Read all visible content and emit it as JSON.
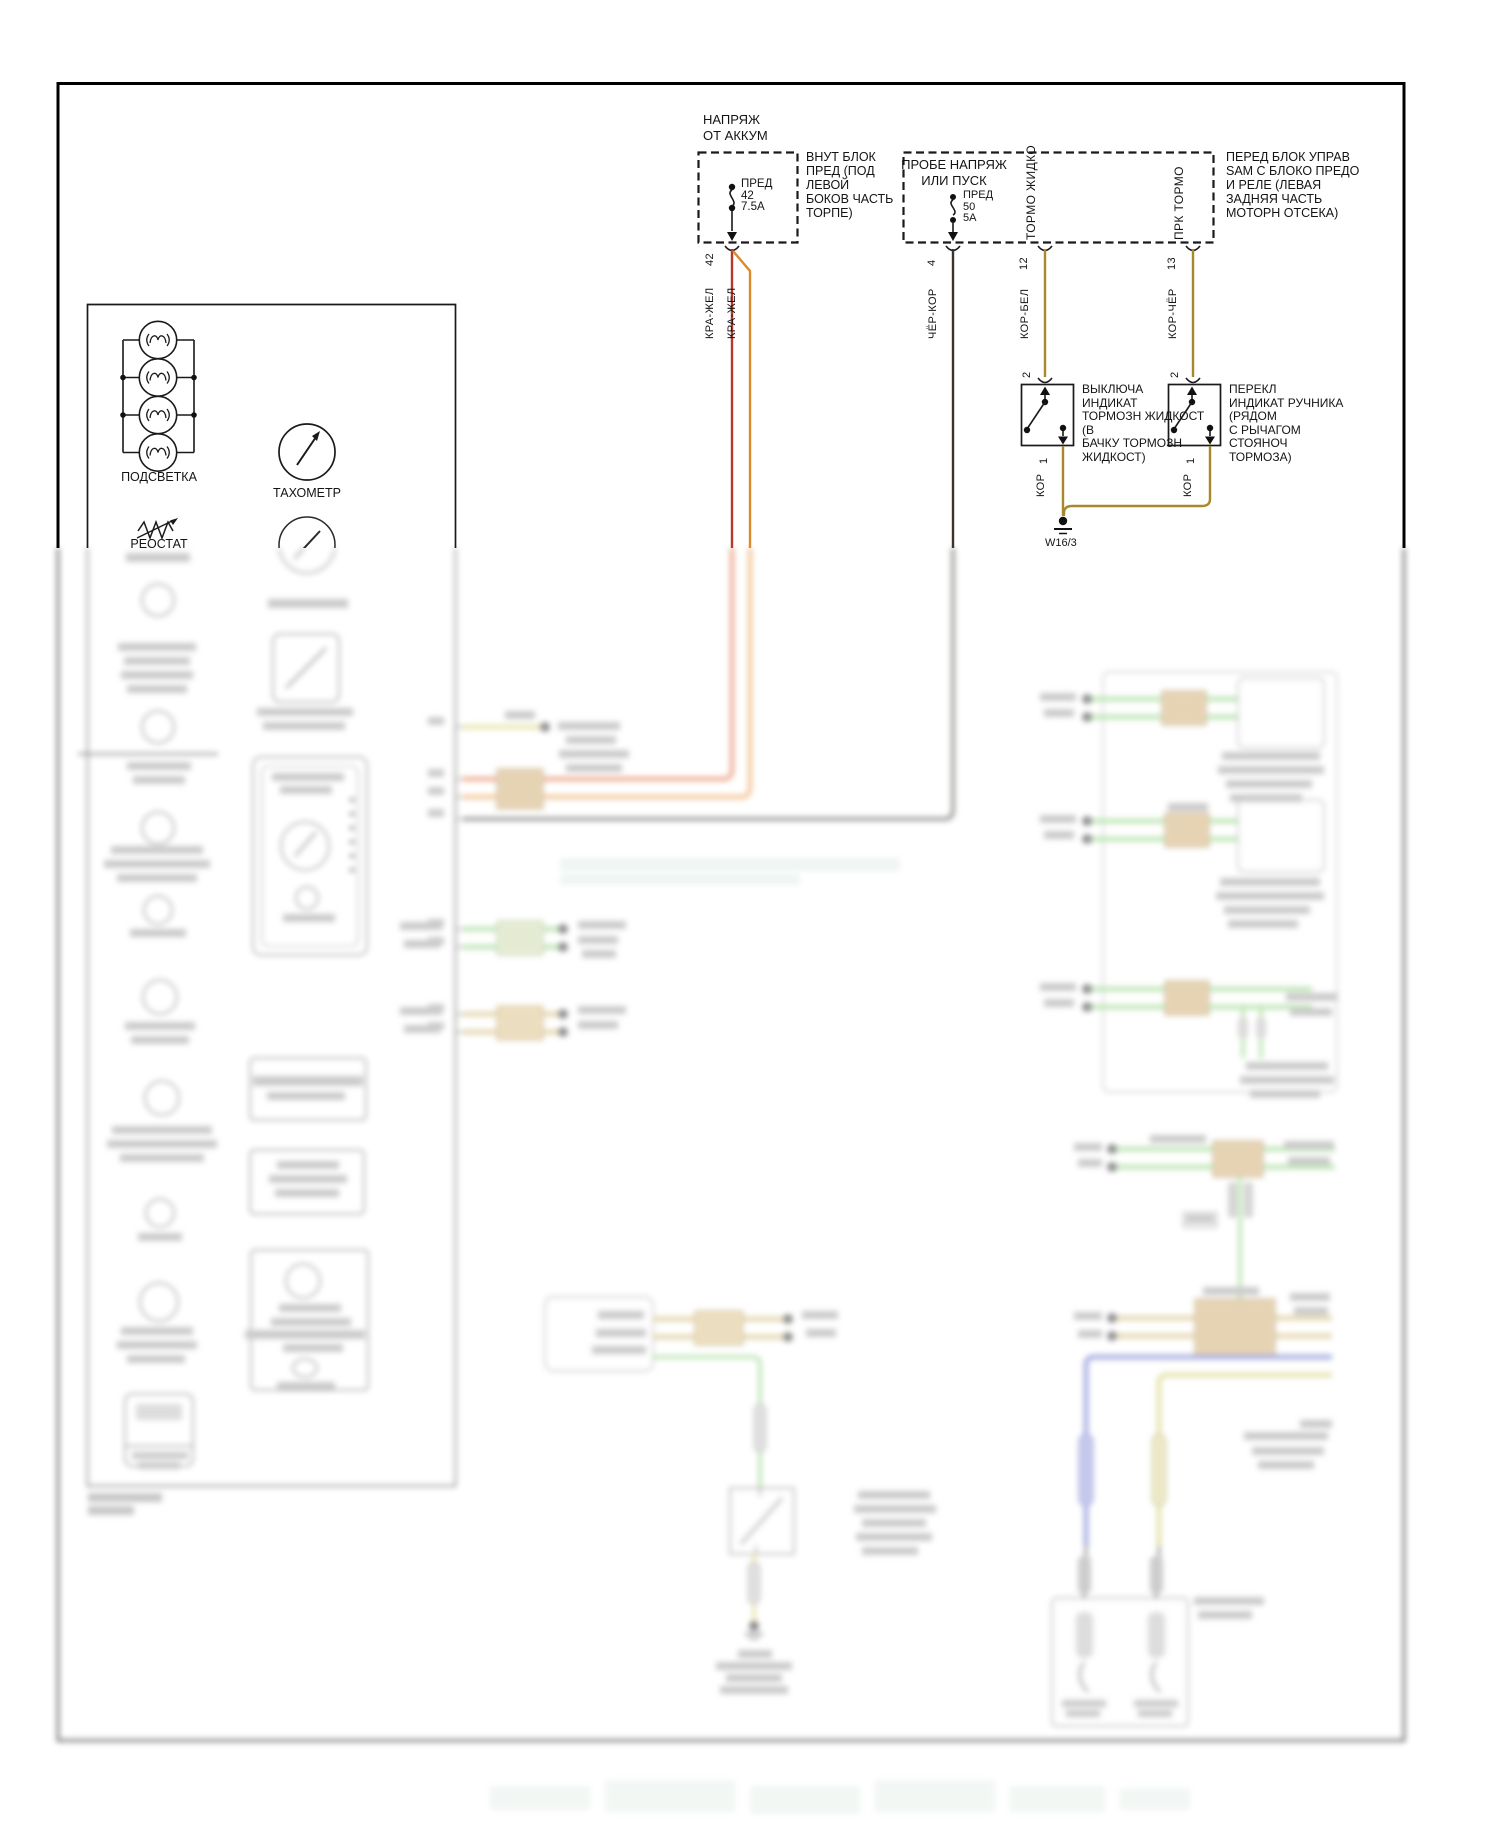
{
  "page": {
    "kind": "automotive wiring diagram (Russian, instrument cluster / brake indicator circuit)"
  },
  "battery_feed": {
    "title": "НАПРЯЖ\nОТ АККУМ",
    "fuse": "ПРЕД\n42\n7.5А",
    "note": "ВНУТ БЛОК\nПРЕД (ПОД\nЛЕВОЙ\nБОКОВ ЧАСТЬ\nТОРПЕ)",
    "pin": "42",
    "wire_color_1": "КРА-ЖЕЛ",
    "wire_color_2": "КРА-ЖЕЛ"
  },
  "sam_block": {
    "title": "ПРОБЕ НАПРЯЖ\nИЛИ ПУСК",
    "fuse": "ПРЕД\n50\n5А",
    "note": "ПЕРЕД БЛОК УПРАВ\nSAM С БЛОКО ПРЕДО\nИ РЕЛЕ (ЛЕВАЯ\nЗАДНЯЯ ЧАСТЬ\nМОТОРН ОТСЕКА)",
    "pin_4": "4",
    "pin_12": "12",
    "pin_13": "13",
    "pin_label_12": "ТОРМО ЖИДКО",
    "pin_label_13": "ПРК ТОРМО",
    "wire_4": "ЧЁР-КОР",
    "wire_12": "КОР-БЕЛ",
    "wire_13": "КОР-ЧЁР"
  },
  "brake_fluid_switch": {
    "label": "ВЫКЛЮЧА\nИНДИКАТ\nТОРМОЗН ЖИДКОСТ\n(В\nБАЧКУ ТОРМОЗН\nЖИДКОСТ)",
    "pin_in": "2",
    "pin_out": "1",
    "wire_out": "КОР"
  },
  "park_brake_switch": {
    "label": "ПЕРЕКЛ\nИНДИКАТ РУЧНИКА\n(РЯДОМ\nС РЫЧАГОМ\nСТОЯНОЧ\nТОРМОЗА)",
    "pin_in": "2",
    "pin_out": "1",
    "wire_out": "КОР"
  },
  "ground_point": {
    "id": "W16/3"
  },
  "instrument_cluster": {
    "backlight_label": "ПОДСВЕТКА",
    "tachometer_label": "ТАХОМЕТР",
    "rheostat_label": "РЕОСТАТ"
  },
  "wire_colors_hex": {
    "red": "#b5382a",
    "orange_yellow": "#dd8a2e",
    "black_brown": "#3d332a",
    "brown_gold": "#a8882e"
  }
}
